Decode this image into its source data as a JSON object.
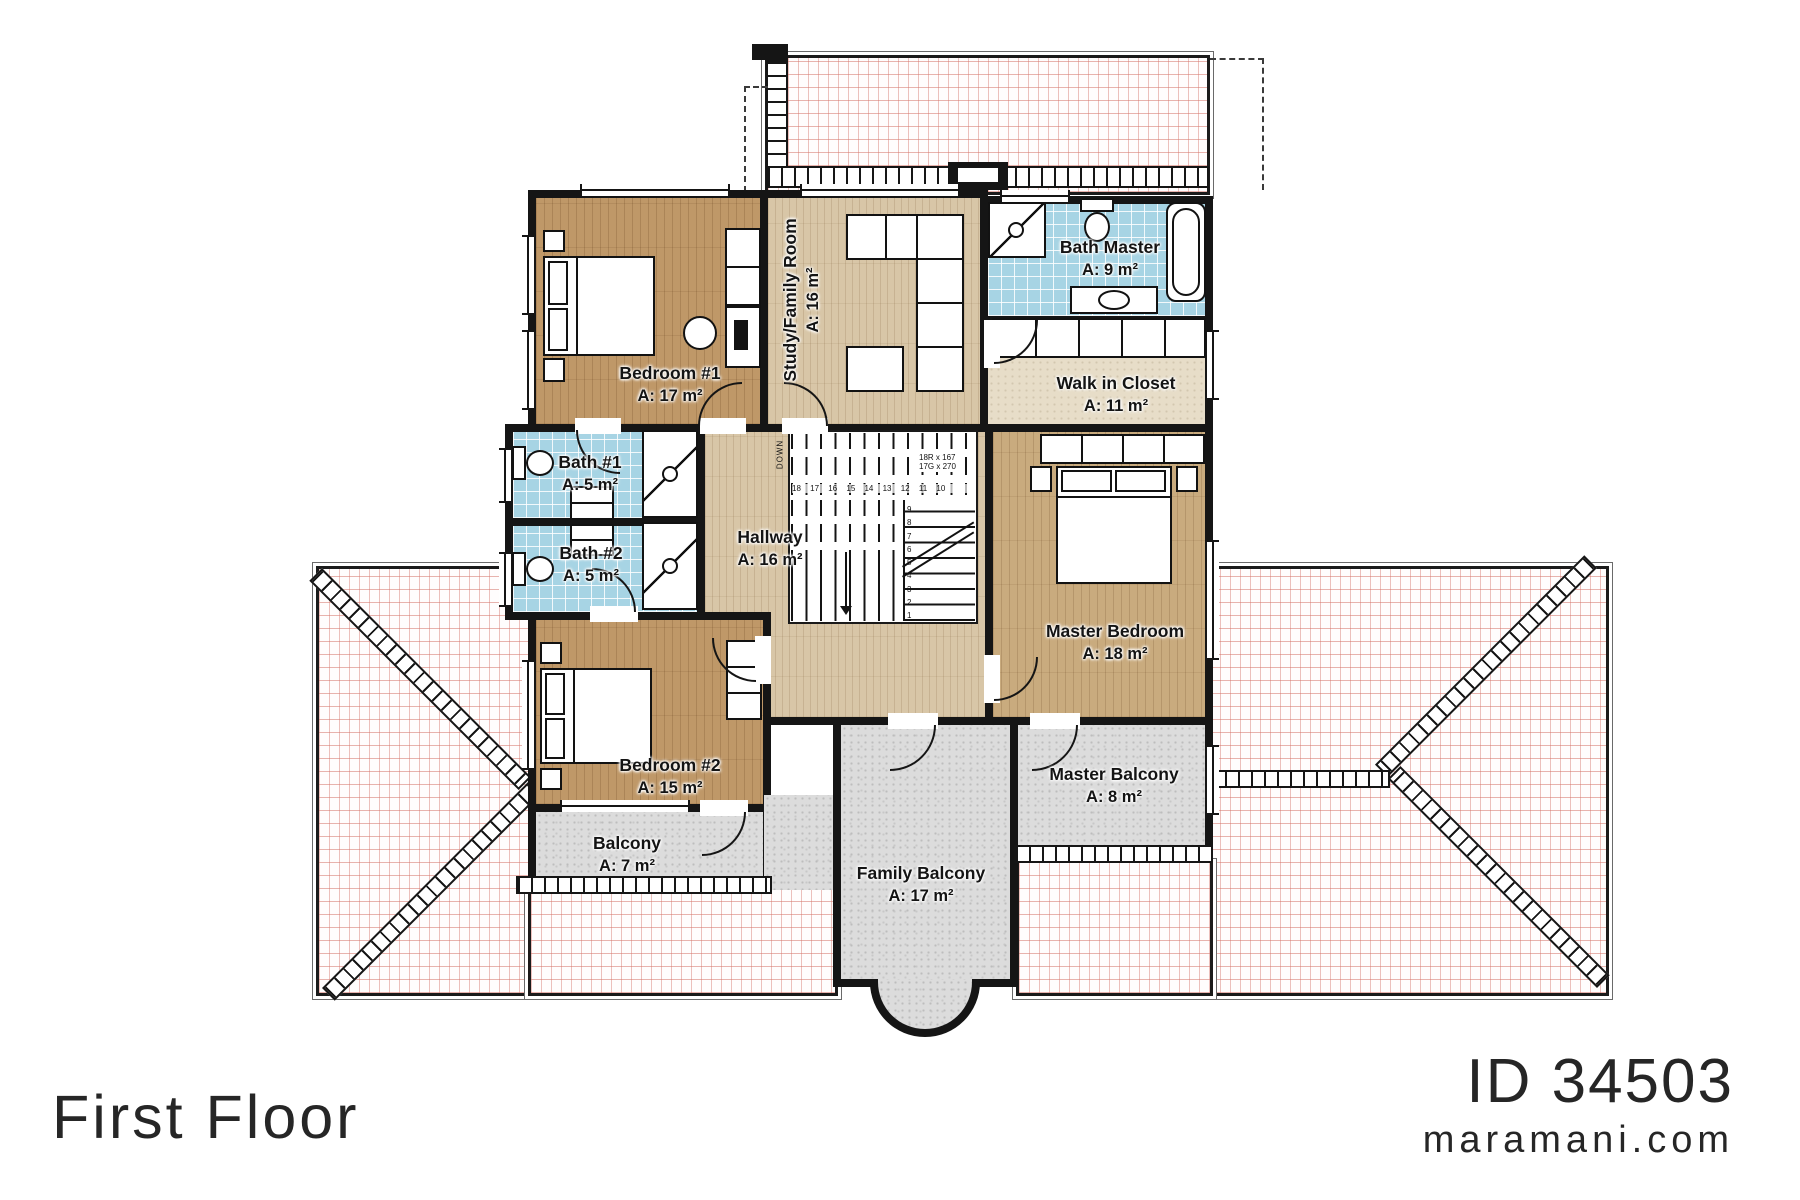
{
  "footer": {
    "floor_title": "First Floor",
    "plan_id": "ID 34503",
    "website": "maramani.com"
  },
  "rooms": [
    {
      "name": "Bedroom #1",
      "area": "A: 17 m²"
    },
    {
      "name": "Study/Family Room",
      "area": "A: 16 m²"
    },
    {
      "name": "Bath Master",
      "area": "A: 9 m²"
    },
    {
      "name": "Walk in Closet",
      "area": "A: 11 m²"
    },
    {
      "name": "Bath #1",
      "area": "A: 5 m²"
    },
    {
      "name": "Bath #2",
      "area": "A: 5 m²"
    },
    {
      "name": "Hallway",
      "area": "A: 16 m²"
    },
    {
      "name": "Master Bedroom",
      "area": "A: 18 m²"
    },
    {
      "name": "Bedroom #2",
      "area": "A: 15 m²"
    },
    {
      "name": "Balcony",
      "area": "A: 7 m²"
    },
    {
      "name": "Family Balcony",
      "area": "A: 17 m²"
    },
    {
      "name": "Master Balcony",
      "area": "A: 8 m²"
    }
  ],
  "stairs": {
    "down_label": "DOWN",
    "dim_line1": "18R x 167",
    "dim_line2": "17G x 270",
    "upper_run_numbers": "18 17 16 15 14 13 12 11 10",
    "lower_run_numbers": "9\n8\n7\n6\n5\n4\n3\n2\n1"
  },
  "colors": {
    "wall": "#151515",
    "bath_tile": "#a7d4e4",
    "bedroom_wood": "#bf9868",
    "hallway_wood": "#d8c6a7",
    "closet_floor": "#e7ddc8",
    "balcony_stone": "#dcdcdc",
    "roof_hatch": "#d6766c"
  }
}
